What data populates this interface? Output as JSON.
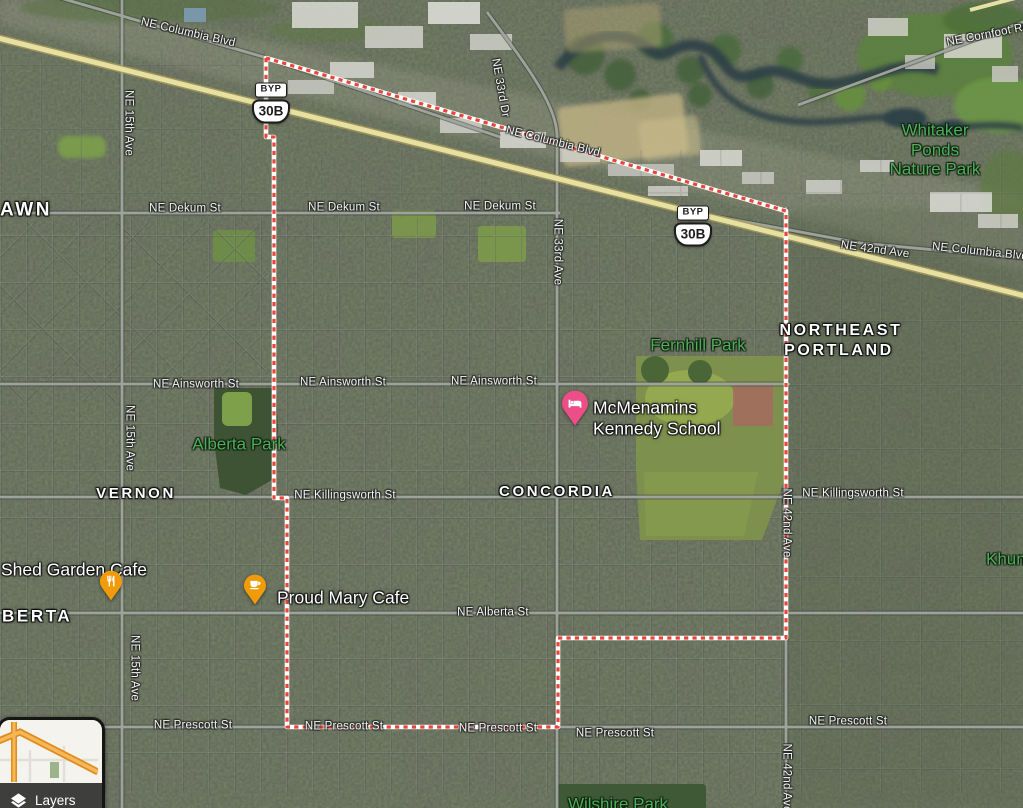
{
  "colors": {
    "boundary_red": "#e8463a",
    "boundary_white": "#ffffff",
    "highway_yellow": "#e6e0a2",
    "park_label_green": "#4fae57",
    "food_pin_orange": "#f09b0a",
    "lodging_pin_pink": "#ec4f87"
  },
  "street_labels": [
    {
      "t": "NE Columbia Blvd",
      "x": 188,
      "y": 33,
      "r": 13
    },
    {
      "t": "NE Columbia Blvd",
      "x": 553,
      "y": 142,
      "r": 14
    },
    {
      "t": "NE Columbia Blvd",
      "x": 980,
      "y": 252,
      "r": 6
    },
    {
      "t": "NE Cornfoot Rd",
      "x": 988,
      "y": 35,
      "r": -11
    },
    {
      "t": "NE 33rd Dr",
      "x": 500,
      "y": 88,
      "r": 80
    },
    {
      "t": "NE 33rd Ave",
      "x": 557,
      "y": 252,
      "r": 90
    },
    {
      "t": "NE 42nd Ave",
      "x": 875,
      "y": 250,
      "r": 8
    },
    {
      "t": "NE 42nd Ave",
      "x": 786,
      "y": 523,
      "r": 90
    },
    {
      "t": "NE 42nd Ave",
      "x": 786,
      "y": 778,
      "r": 90
    },
    {
      "t": "NE 15th Ave",
      "x": 128,
      "y": 123,
      "r": 90
    },
    {
      "t": "NE 15th Ave",
      "x": 129,
      "y": 438,
      "r": 90
    },
    {
      "t": "NE 15th Ave",
      "x": 134,
      "y": 668,
      "r": 90
    },
    {
      "t": "NE Dekum St",
      "x": 185,
      "y": 209
    },
    {
      "t": "NE Dekum St",
      "x": 344,
      "y": 208
    },
    {
      "t": "NE Dekum St",
      "x": 500,
      "y": 207
    },
    {
      "t": "NE Ainsworth St",
      "x": 196,
      "y": 385
    },
    {
      "t": "NE Ainsworth St",
      "x": 343,
      "y": 383
    },
    {
      "t": "NE Ainsworth St",
      "x": 494,
      "y": 382
    },
    {
      "t": "NE Killingsworth St",
      "x": 345,
      "y": 496
    },
    {
      "t": "NE Killingsworth St",
      "x": 853,
      "y": 494
    },
    {
      "t": "NE Alberta St",
      "x": 493,
      "y": 613
    },
    {
      "t": "NE Prescott St",
      "x": 193,
      "y": 726
    },
    {
      "t": "NE Prescott St",
      "x": 344,
      "y": 727
    },
    {
      "t": "NE Prescott St",
      "x": 498,
      "y": 729
    },
    {
      "t": "NE Prescott St",
      "x": 615,
      "y": 734
    },
    {
      "t": "NE Prescott St",
      "x": 848,
      "y": 722
    }
  ],
  "area_labels": [
    {
      "t": "AWN",
      "x": 0,
      "y": 211,
      "size": 19,
      "align": "left"
    },
    {
      "t": "VERNON",
      "x": 136,
      "y": 494
    },
    {
      "t": "CONCORDIA",
      "x": 557,
      "y": 492
    },
    {
      "t": "NORTHEAST",
      "x": 841,
      "y": 331,
      "size": 16
    },
    {
      "t": "PORTLAND",
      "x": 839,
      "y": 351,
      "size": 16
    },
    {
      "t": "BERTA",
      "x": 2,
      "y": 617,
      "size": 17,
      "align": "left"
    }
  ],
  "park_labels": [
    {
      "t": "Alberta Park",
      "x": 239,
      "y": 445
    },
    {
      "t": "Fernhill Park",
      "x": 698,
      "y": 346
    },
    {
      "t": "Whitaker",
      "x": 935,
      "y": 131
    },
    {
      "t": "Ponds",
      "x": 935,
      "y": 151
    },
    {
      "t": "Nature Park",
      "x": 935,
      "y": 170
    },
    {
      "t": "Khuna",
      "x": 986,
      "y": 560,
      "align": "left"
    },
    {
      "t": "Wilshire Park",
      "x": 618,
      "y": 805
    }
  ],
  "pois": [
    {
      "id": "mcmenamins-kennedy-school",
      "lines": [
        "McMenamins",
        "Kennedy School"
      ],
      "pin": "lodging",
      "pin_x": 575,
      "pin_y": 431,
      "label_x": 593,
      "label_y": 408,
      "line_h": 21
    },
    {
      "id": "proud-mary-cafe",
      "lines": [
        "Proud Mary Cafe"
      ],
      "pin": "cafe",
      "pin_x": 255,
      "pin_y": 610,
      "label_x": 277,
      "label_y": 598,
      "line_h": 21
    },
    {
      "id": "shed-garden-cafe",
      "lines": [
        "Shed Garden Cafe"
      ],
      "pin": "restaurant",
      "pin_x": 111,
      "pin_y": 606,
      "label_x": 1,
      "label_y": 570,
      "line_h": 21
    }
  ],
  "route_shields": [
    {
      "bypass": "BYP",
      "route": "30B",
      "x": 271,
      "y": 103
    },
    {
      "bypass": "BYP",
      "route": "30B",
      "x": 693,
      "y": 226
    }
  ],
  "layers_control": {
    "label": "Layers"
  }
}
